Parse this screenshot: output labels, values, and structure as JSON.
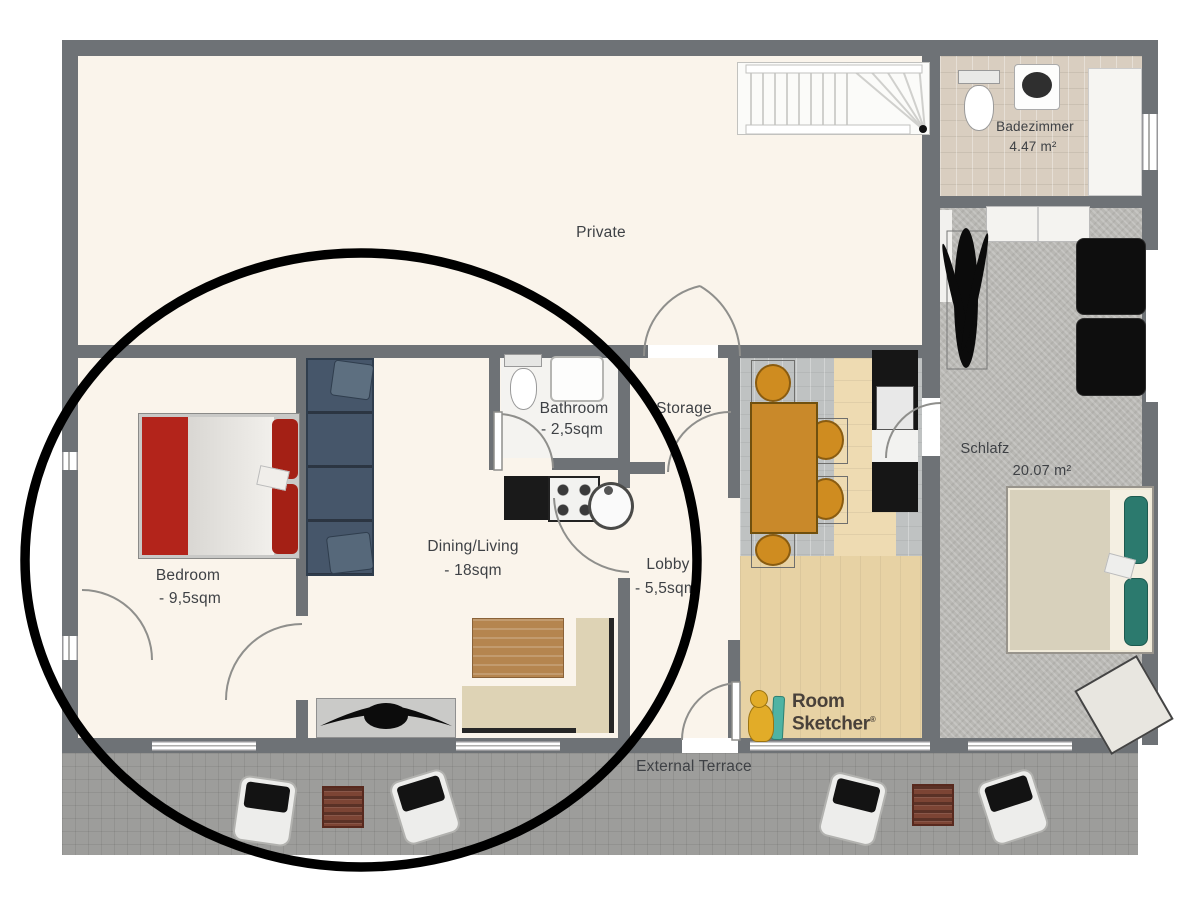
{
  "rooms": {
    "private": {
      "name": "Private"
    },
    "badezimmer": {
      "name": "Badezimmer",
      "area": "4.47 m²"
    },
    "schlafzimmer": {
      "name": "Schlafz",
      "area": "20.07 m²"
    },
    "bathroom": {
      "name": "Bathroom",
      "area": "- 2,5sqm"
    },
    "storage": {
      "name": "Storage"
    },
    "bedroom": {
      "name": "Bedroom",
      "area": "- 9,5sqm"
    },
    "dining_living": {
      "name": "Dining/Living",
      "area": "- 18sqm"
    },
    "lobby": {
      "name": "Lobby",
      "area": "- 5,5sqm"
    },
    "terrace": {
      "name": "External Terrace"
    }
  },
  "branding": {
    "logo_line1": "Room",
    "logo_line2": "Sketcher",
    "registered": "®"
  },
  "annotation": {
    "shape": "ellipse",
    "color": "#000000"
  },
  "colors": {
    "wall": "#6e7276",
    "floor_cream": "#faf4eb",
    "terrace_gray": "#9d9d9b",
    "tile_beige": "#d9cec0",
    "carpet_gray": "#b9b8b4",
    "wood": "#ecd9ae",
    "bed_red": "#b3241b",
    "pillow_teal": "#2c7a6e",
    "table_orange": "#c9892a",
    "sofa_slate": "#46566a",
    "furniture_black": "#121212"
  }
}
